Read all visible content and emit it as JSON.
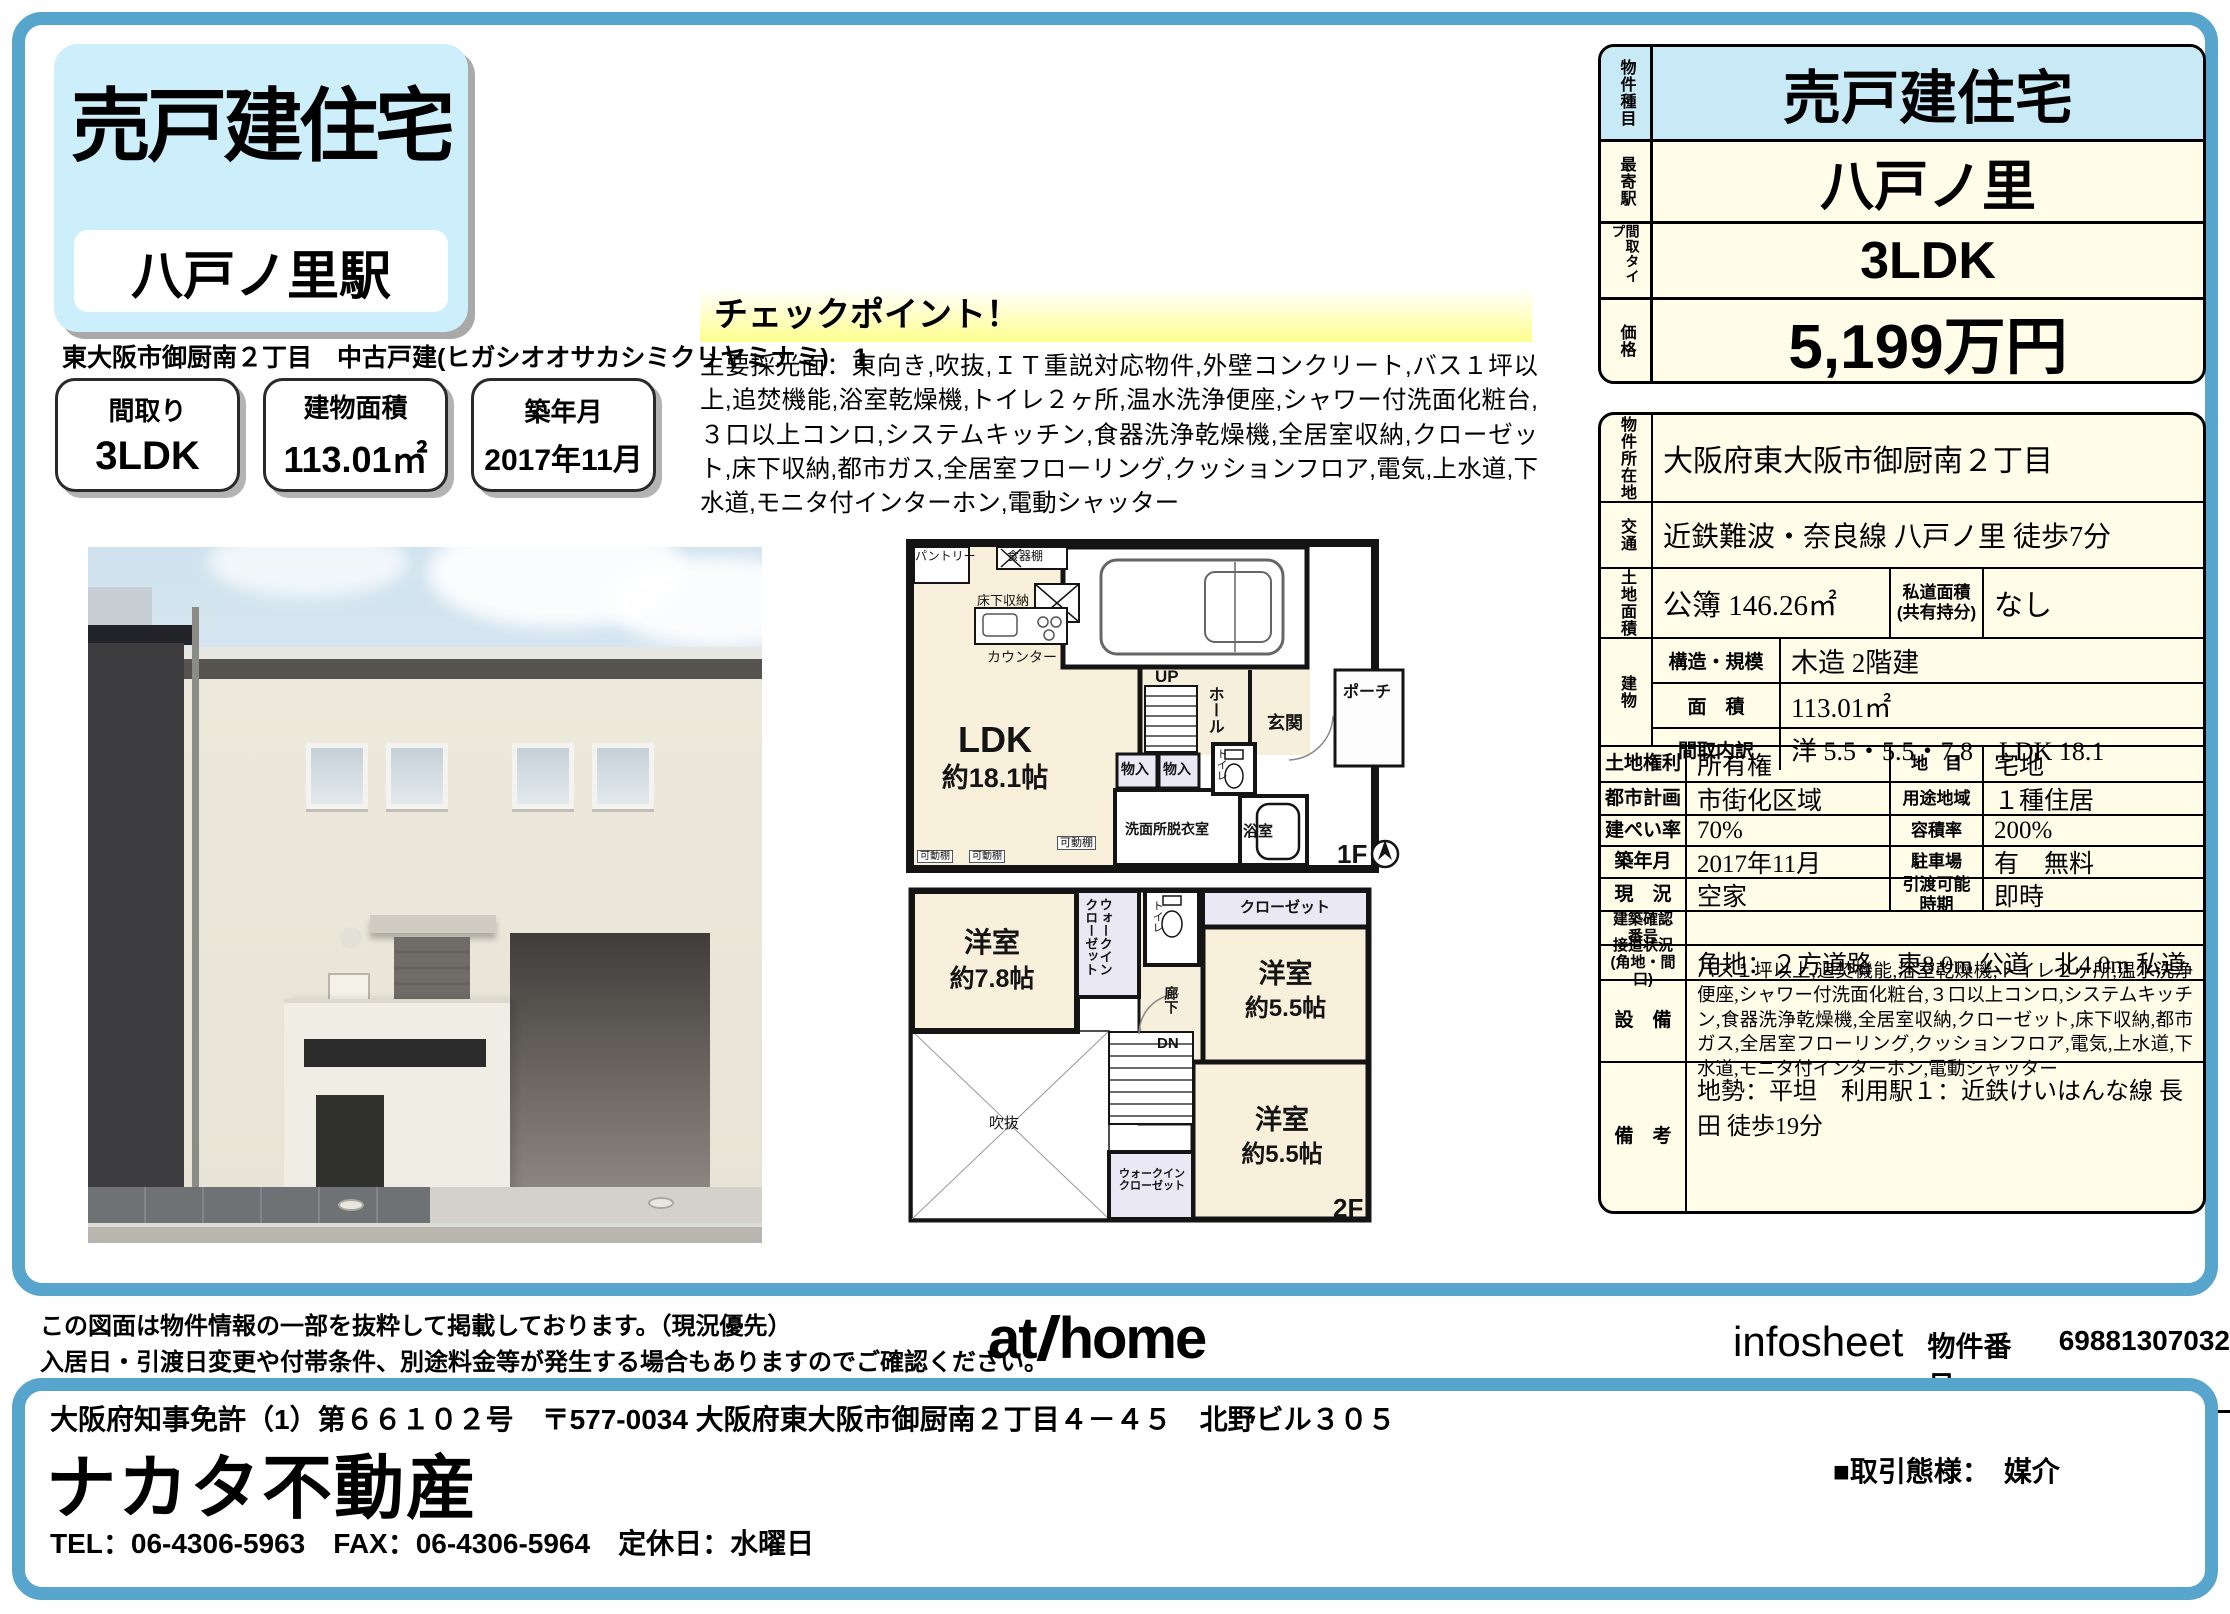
{
  "colors": {
    "frame_blue": "#57a5cd",
    "header_blue": "#cdeefb",
    "table_cream": "#fffce8",
    "type_row_blue": "#c8e9f6",
    "checkpoint_yellow": "#ffff8e"
  },
  "header": {
    "title": "売戸建住宅",
    "station": "八戸ノ里駅",
    "address_line": "東大阪市御厨南２丁目　中古戸建(ヒガシオオサカシミクリヤミナミ)　1"
  },
  "summary": {
    "boxes": [
      {
        "label": "間取り",
        "value": "3LDK"
      },
      {
        "label": "建物面積",
        "value": "113.01㎡"
      },
      {
        "label": "築年月",
        "value": "2017年11月"
      }
    ]
  },
  "checkpoint": {
    "title": "チェックポイント！",
    "body": "主要採光面：東向き,吹抜,ＩＴ重説対応物件,外壁コンクリート,バス１坪以上,追焚機能,浴室乾燥機,トイレ２ヶ所,温水洗浄便座,シャワー付洗面化粧台,３口以上コンロ,システムキッチン,食器洗浄乾燥機,全居室収納,クローゼット,床下収納,都市ガス,全居室フローリング,クッションフロア,電気,上水道,下水道,モニタ付インターホン,電動シャッター"
  },
  "floorplan1": {
    "pantry": "パントリー",
    "dish_shelf": "食器棚",
    "underfloor": "床下収納",
    "counter": "カウンター",
    "ldk": "LDK",
    "ldk_size": "約18.1帖",
    "up": "UP",
    "hall": "ホール",
    "entrance": "玄関",
    "porch": "ポーチ",
    "toilet": "トイレ",
    "storage1": "物入",
    "storage2": "物入",
    "washroom": "洗面所脱衣室",
    "bath": "浴室",
    "shelf1": "可動棚",
    "shelf2": "可動棚",
    "shelf3": "可動棚",
    "floor": "1F"
  },
  "floorplan2": {
    "room78": "洋室",
    "room78_size": "約7.8帖",
    "wic1": "ウォークイン\nクローゼット",
    "toilet": "トイレ",
    "closet": "クローゼット",
    "room55a": "洋室",
    "room55a_size": "約5.5帖",
    "hallway": "廊下",
    "dn": "DN",
    "void": "吹抜",
    "wic2": "ウォークイン\nクローゼット",
    "room55b": "洋室",
    "room55b_size": "約5.5帖",
    "floor": "2F"
  },
  "side_top": {
    "rows": [
      {
        "label": "物件種目",
        "value": "売戸建住宅"
      },
      {
        "label": "最寄駅",
        "value": "八戸ノ里"
      },
      {
        "label": "間取タイプ",
        "value": "3LDK"
      },
      {
        "label": "価格",
        "value": "5,199万円"
      }
    ]
  },
  "detail": {
    "loc_label": "物件所在地",
    "loc": "大阪府東大阪市御厨南２丁目",
    "access_label": "交通",
    "access": "近鉄難波・奈良線 八戸ノ里 徒歩7分",
    "land_label": "土地面積",
    "land": "公簿 146.26㎡",
    "proad_label": "私道面積\n(共有持分)",
    "proad": "なし",
    "bldg_label": "建物",
    "structure_label": "構造・規模",
    "structure": "木造 2階建",
    "barea_label": "面　積",
    "barea": "113.01㎡",
    "layout_label": "間取内訳",
    "layout": "洋 5.5・5.5・7.8　LDK 18.1",
    "right_label": "土地権利",
    "right": "所有権",
    "chimoku_label": "地　目",
    "chimoku": "宅地",
    "city_label": "都市計画",
    "city": "市街化区域",
    "youto_label": "用途地域",
    "youto": "１種住居",
    "kenpei_label": "建ぺい率",
    "kenpei": "70%",
    "yoseki_label": "容積率",
    "yoseki": "200%",
    "built_label": "築年月",
    "built": "2017年11月",
    "parking_label": "駐車場",
    "parking": "有　無料",
    "status_label": "現　況",
    "status": "空家",
    "handover_label": "引渡可能\n時期",
    "handover": "即時",
    "confirm_label": "建築確認\n番号",
    "confirm": "",
    "road_label": "接道状況\n(角地・間口)",
    "road": "角地：２方道路　東8.0m 公道　北4.0m 私道",
    "equip_label": "設　備",
    "equip": "バス１坪以上,追焚機能,浴室乾燥機,トイレ２ヶ所,温水洗浄便座,シャワー付洗面化粧台,３口以上コンロ,システムキッチン,食器洗浄乾燥機,全居室収納,クローゼット,床下収納,都市ガス,全居室フローリング,クッションフロア,電気,上水道,下水道,モニタ付インターホン,電動シャッター",
    "note_label": "備　考",
    "note": "地勢：平坦　利用駅１：近鉄けいはんな線 長田 徒歩19分"
  },
  "footer": {
    "disclaimer1": "この図面は物件情報の一部を抜粋して掲載しております。（現況優先）",
    "disclaimer2": "入居日・引渡日変更や付帯条件、別途料金等が発生する場合もありますのでご確認ください。",
    "logo_at": "at",
    "logo_home": "home",
    "infosheet": "infosheet",
    "bukken_label": "物件番号",
    "bukken_no": "69881307032",
    "license": "大阪府知事免許（1）第６６１０２号　〒577-0034 大阪府東大阪市御厨南２丁目４－４５　北野ビル３０５",
    "company": "ナカタ不動産",
    "contact": "TEL：06-4306-5963　FAX：06-4306-5964　定休日：水曜日",
    "deal": "■取引態様：　媒介"
  }
}
